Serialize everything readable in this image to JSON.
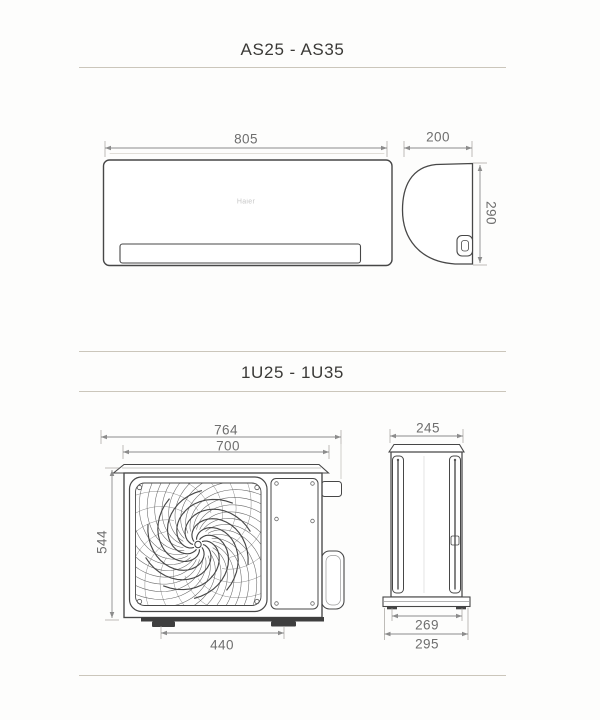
{
  "page": {
    "background": "#fdfdfc",
    "divider_color": "#cbc6bb",
    "drawing_line_color": "#474747",
    "dimension_text_color": "#6e6e6e"
  },
  "sections": [
    {
      "title": "AS25 - AS35",
      "brand_logo": "Haier",
      "dimensions": {
        "front_width": "805",
        "side_depth": "200",
        "side_height": "290"
      }
    },
    {
      "title": "1U25 - 1U35",
      "dimensions": {
        "overall_width": "764",
        "body_width": "700",
        "height": "544",
        "feet_spacing": "440",
        "side_depth": "245",
        "base_inner_depth": "269",
        "base_outer_depth": "295"
      }
    }
  ]
}
